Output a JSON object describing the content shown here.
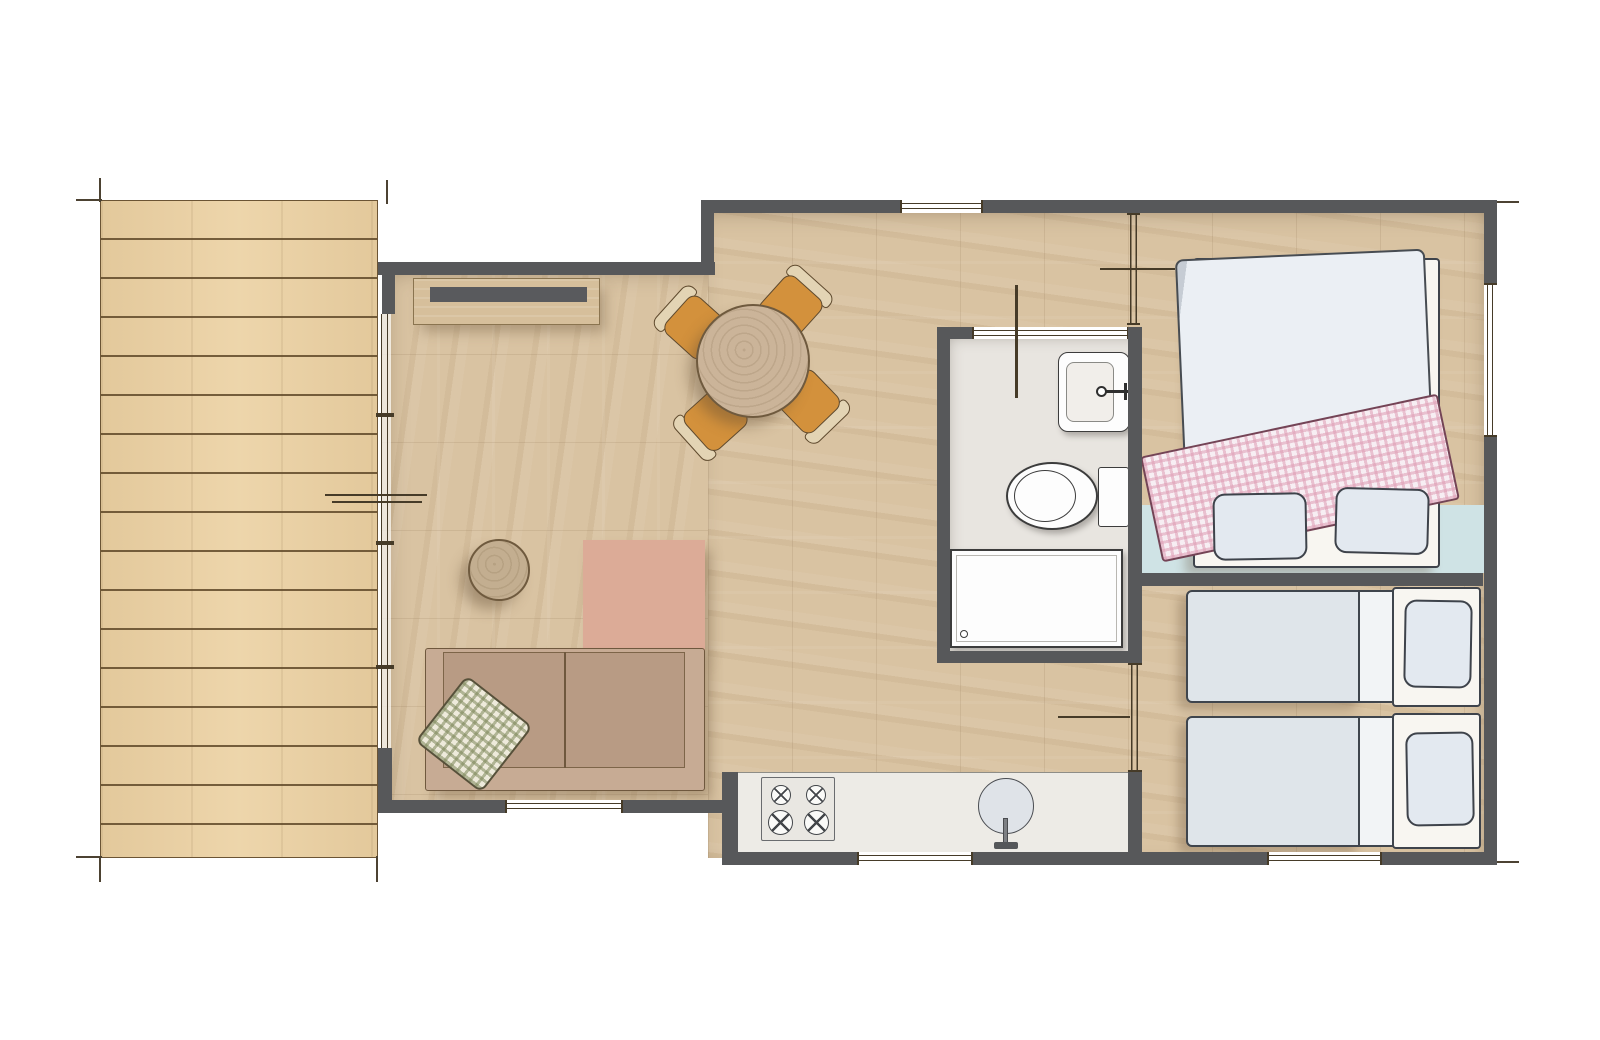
{
  "meta": {
    "type": "architectural-floor-plan",
    "view": "top-down",
    "text_content": "none"
  },
  "colors": {
    "wall": "#57585a",
    "deck": "#ecd2a4",
    "deck_line": "#6b5434",
    "wood": "#d9c3a2",
    "bath_floor": "#e8e5e0",
    "counter": "#edebe6",
    "bench": "#cfe3e5",
    "sideboard": "#d6bf9b",
    "tv": "#595a5d",
    "table": "#cbb499",
    "chair": "#d3913c",
    "chair_frame": "#e3d4b4",
    "side_table": "#c3ae90",
    "ottoman": "#dcab97",
    "sofa": "#c7ab94",
    "sofa_seat": "#b89b84",
    "cushion_base": "#eeeadb",
    "duvet": "#ebeff4",
    "bed_base": "#f8f6f1",
    "mattress": "#dfe5ea",
    "fold": "#f2f4f6",
    "pillow": "#e3e9f0",
    "blanket": "#f7eef3",
    "blanket_edge": "#744456",
    "fixture": "#fdfdfd",
    "win_line": "#463b28"
  },
  "semantics": {
    "areas": [
      "deck-terrace",
      "living-room",
      "kitchenette",
      "bathroom",
      "entry-hall",
      "bedroom-double",
      "bedroom-twin"
    ],
    "living_room_items": [
      "tv-sideboard",
      "tv",
      "round-dining-table",
      "dining-chair-x4",
      "round-side-table",
      "square-ottoman",
      "two-seat-sofa",
      "gingham-cushion"
    ],
    "kitchen_items": [
      "worktop-counter",
      "four-burner-hob",
      "round-sink",
      "faucet"
    ],
    "bathroom_items": [
      "washbasin",
      "toilet",
      "shower-tray"
    ],
    "bedroom_double_items": [
      "double-bed",
      "duvet",
      "gingham-blanket",
      "pillow-x2",
      "headboard-bench"
    ],
    "bedroom_twin_items": [
      "single-bed-x2",
      "pillow-x2"
    ],
    "window_count": 6,
    "door_count": 3,
    "deck_plank_count": 17,
    "hob_burner_count": 4
  }
}
